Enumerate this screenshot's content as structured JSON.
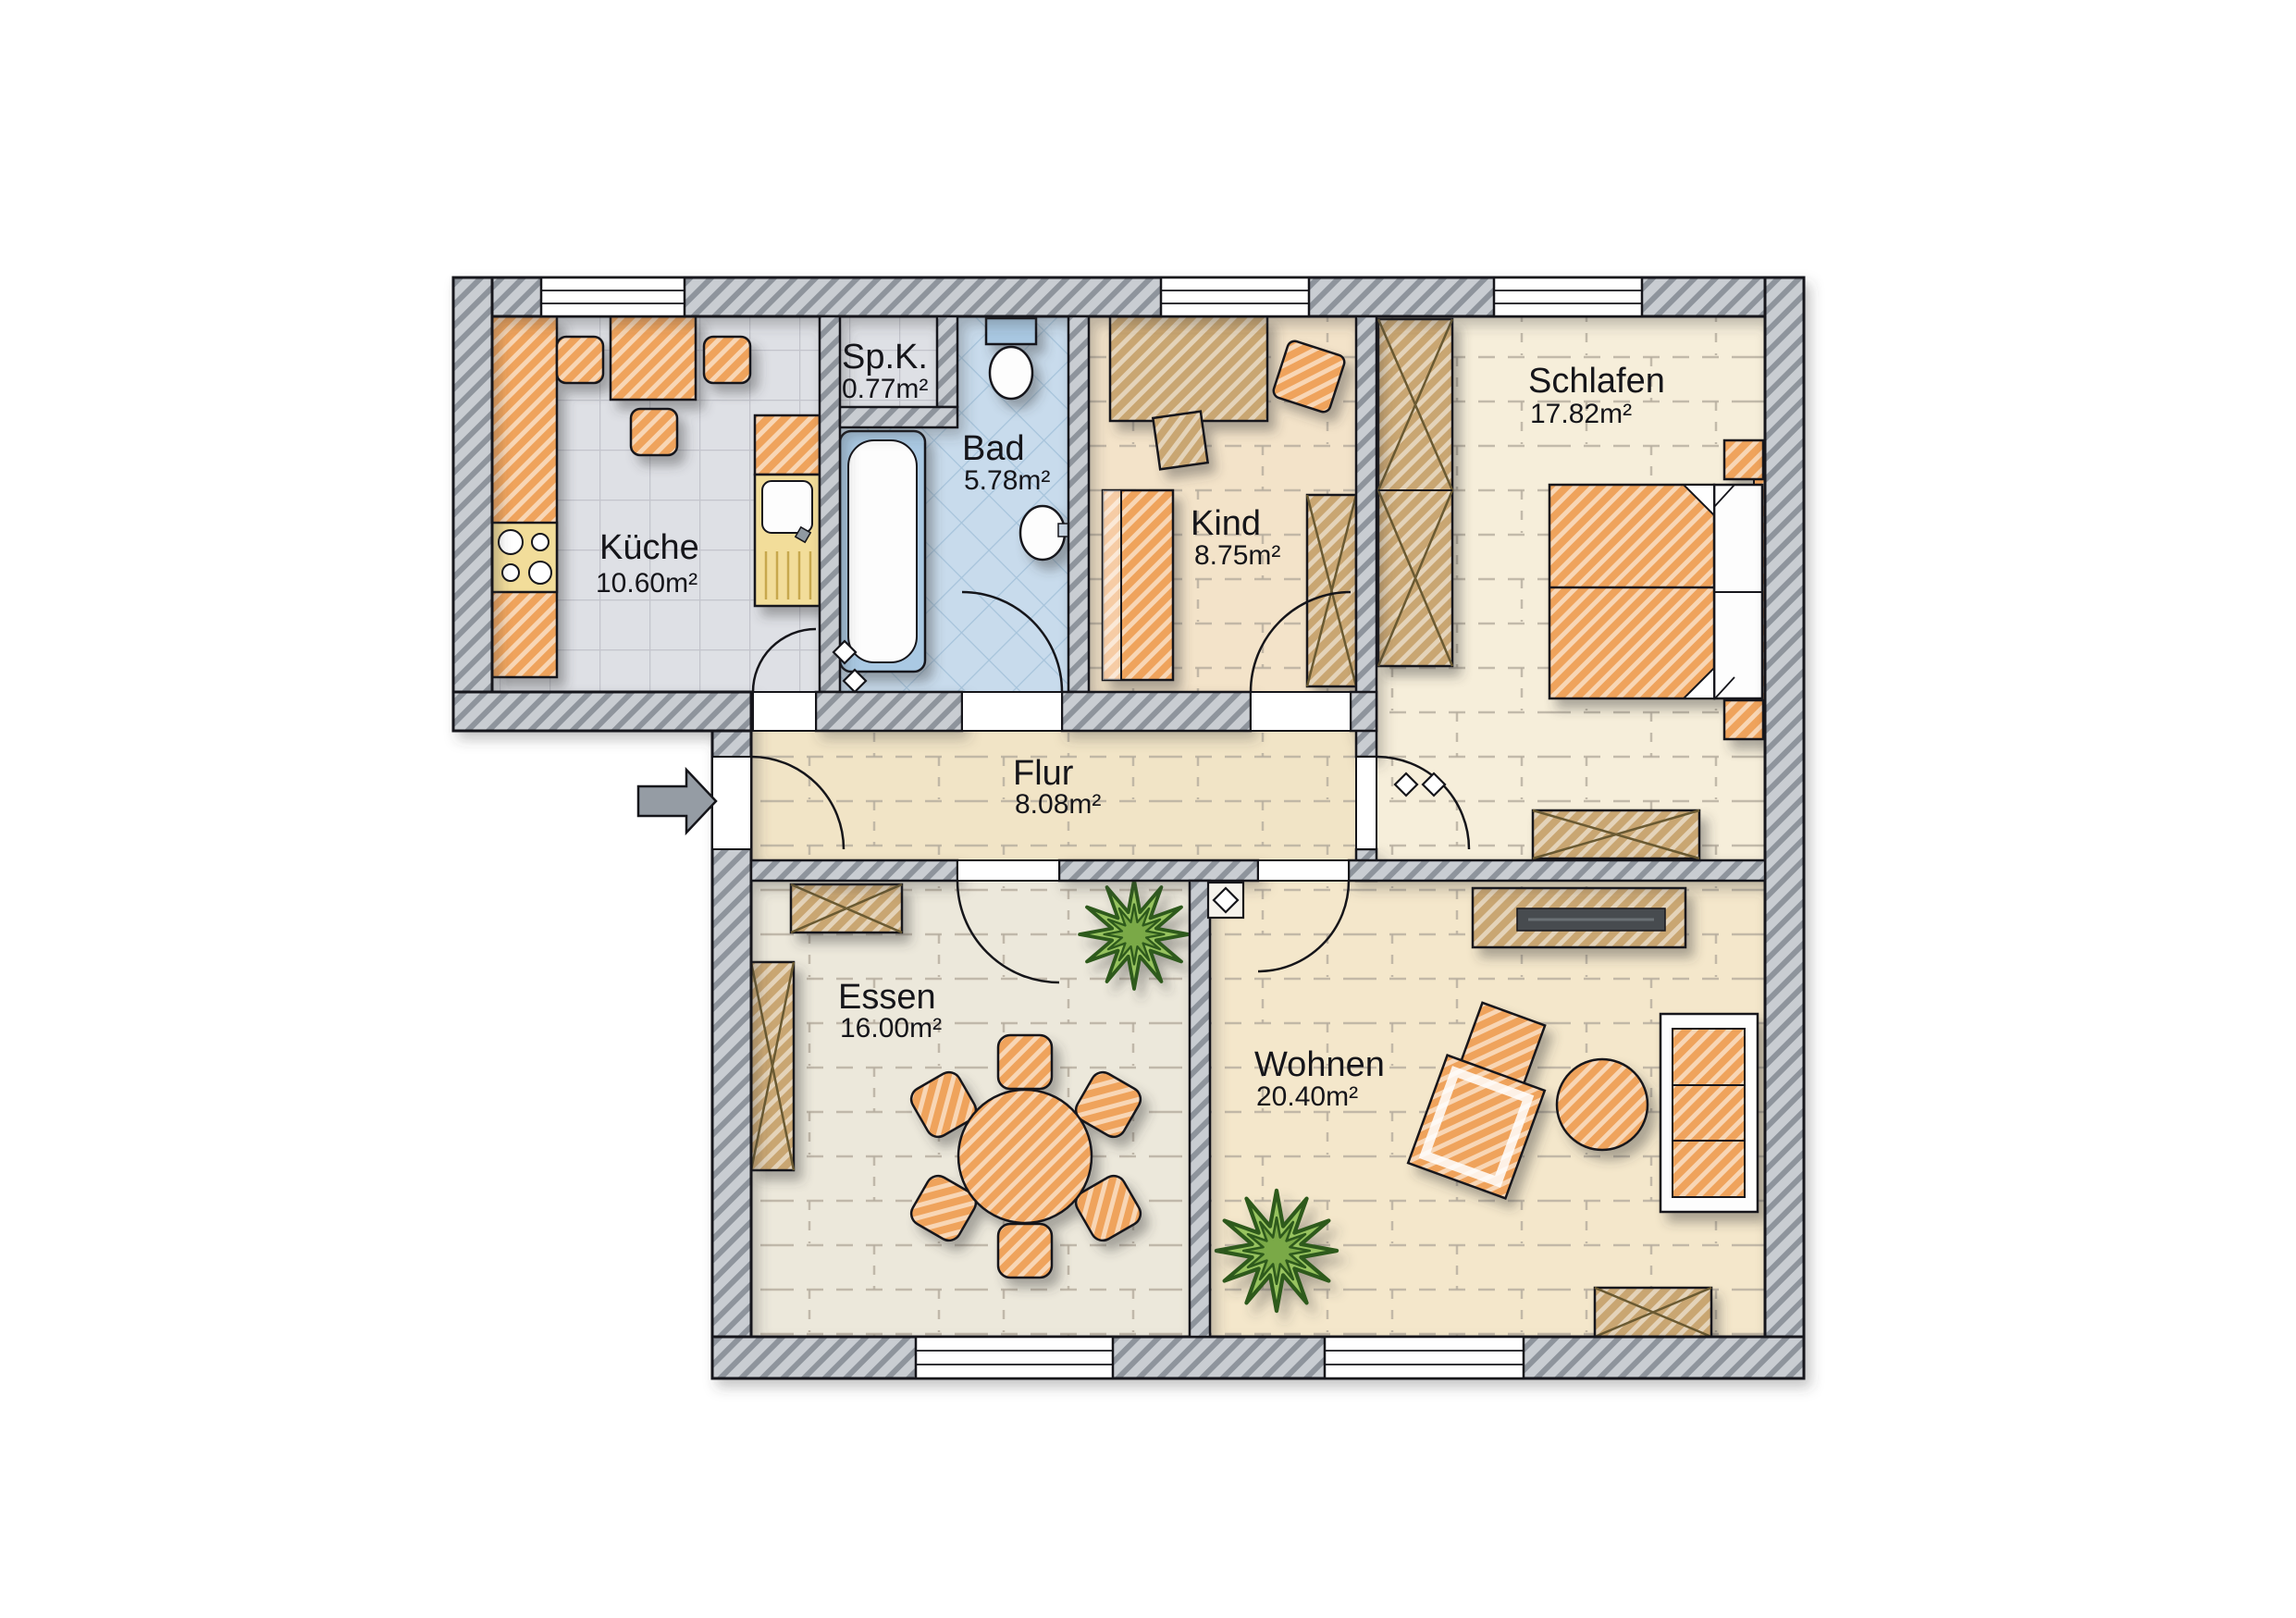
{
  "plan": {
    "rooms": [
      {
        "name": "Küche",
        "area": "10.60m²"
      },
      {
        "name": "Sp.K.",
        "area": "0.77m²"
      },
      {
        "name": "Bad",
        "area": "5.78m²"
      },
      {
        "name": "Kind",
        "area": "8.75m²"
      },
      {
        "name": "Schlafen",
        "area": "17.82m²"
      },
      {
        "name": "Flur",
        "area": "8.08m²"
      },
      {
        "name": "Essen",
        "area": "16.00m²"
      },
      {
        "name": "Wohnen",
        "area": "20.40m²"
      }
    ],
    "colors": {
      "wall_fill": "#c9cdd2",
      "wall_hatch": "#8e949c",
      "floor_tile_gray": "#dee0e5",
      "floor_tile_blue": "#c8dbec",
      "floor_wood_warm": "#f3e2c4",
      "floor_wood_light": "#f6eeda",
      "floor_stone_gray": "#ece8db",
      "furniture_orange": "#efa35b",
      "furniture_wood": "#c9a672",
      "appliance_yellow": "#f2dd9a",
      "plant_green": "#97c35f",
      "outline": "#15151a"
    }
  }
}
